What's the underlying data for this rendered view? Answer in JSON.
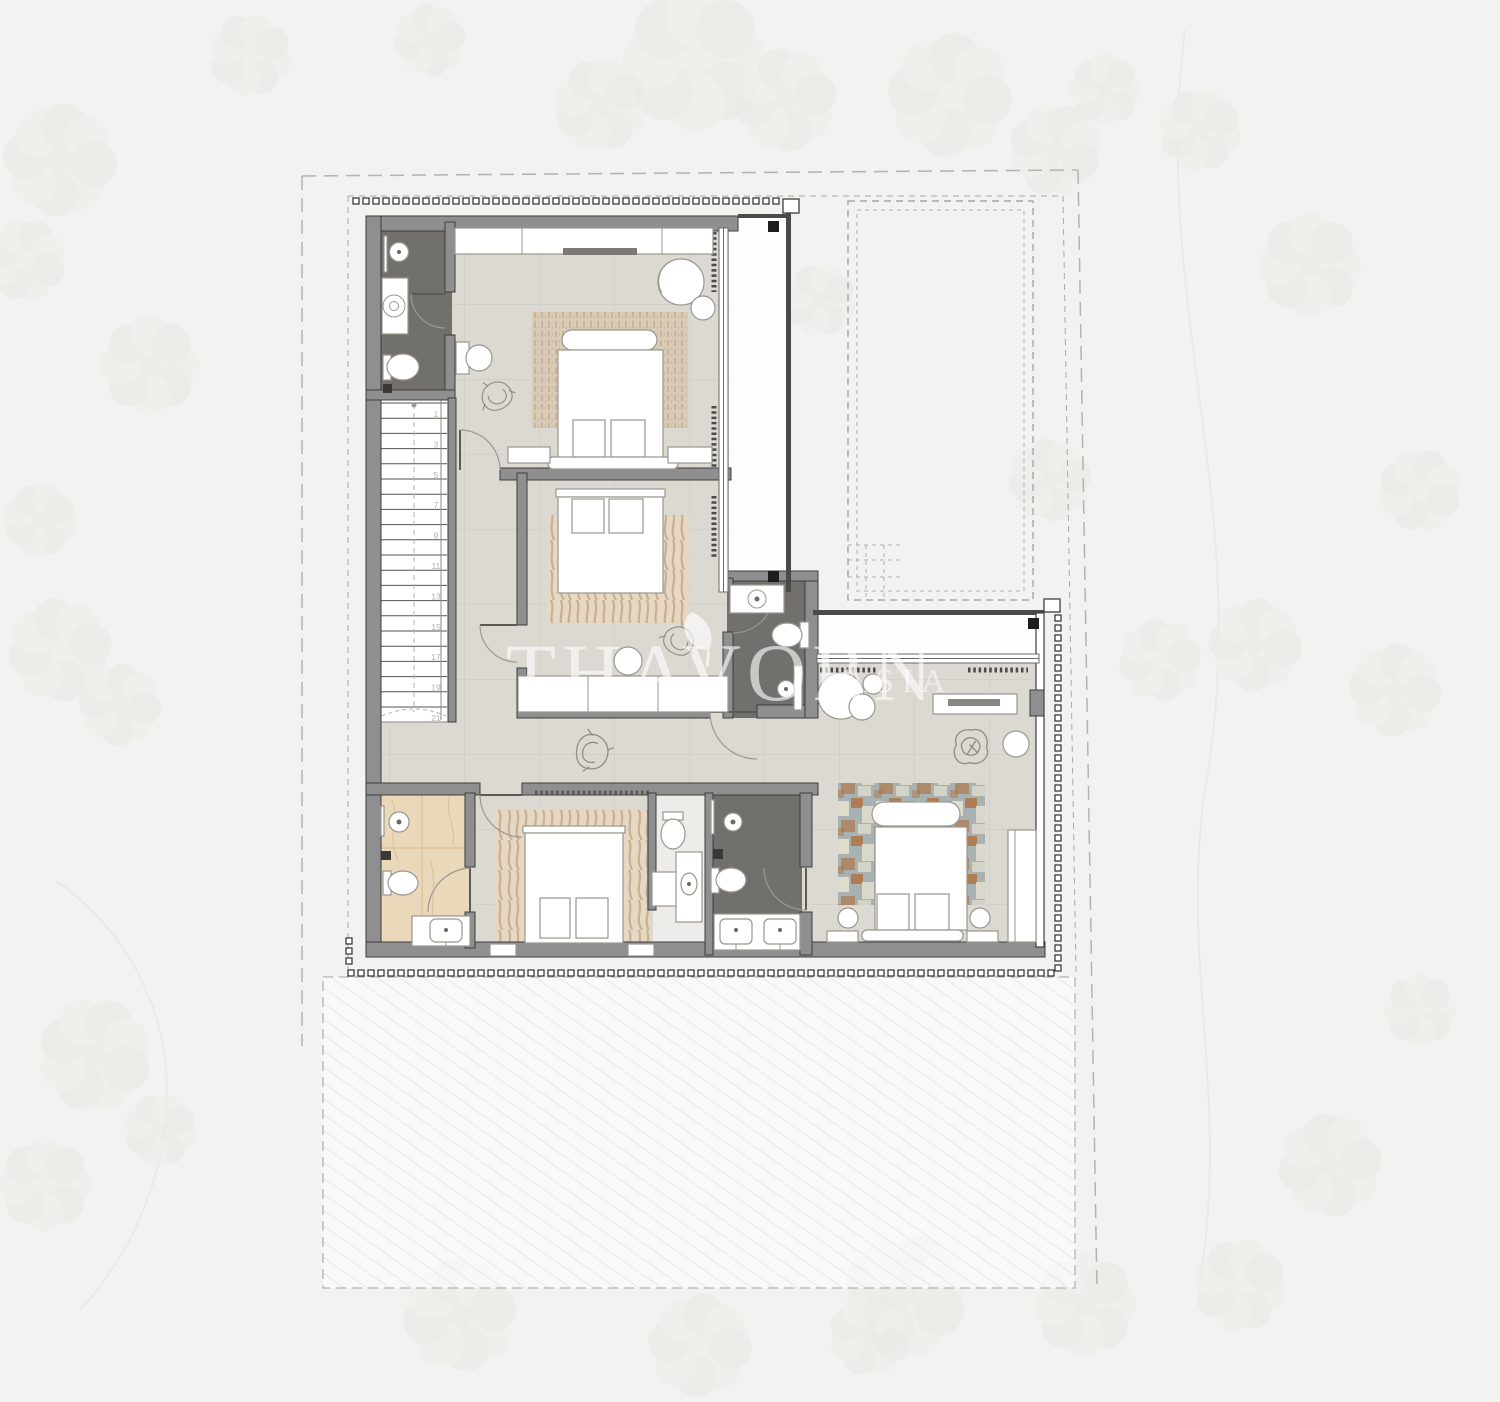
{
  "watermark": {
    "brand": "THAVORN",
    "region": "ASIA"
  },
  "stairs": {
    "labels": [
      "1",
      "3",
      "5",
      "7",
      "9",
      "11",
      "13",
      "15",
      "17",
      "19",
      "21"
    ]
  },
  "palette": {
    "bg": "#f2f2f0",
    "foliage": "#e9ebe6",
    "foliage2": "#eef0eb",
    "hatch": "#e3e3e1",
    "dash": "#b3b3b1",
    "setback": "#a8a8a6",
    "wall_fill": "#8f8f8f",
    "wall_edge": "#3d3d3d",
    "wall_dark": "#4a4a4a",
    "floor": "#dcd9d3",
    "floor_line": "#c9c6c0",
    "dark_bath": "#72706c",
    "beige_bath": "#e9d8ba",
    "beige_vein": "#d9ba8c",
    "rug_beige": "#d9cbb5",
    "rug_stripe": "#c0ab8f",
    "zebra_base": "#e7d8c4",
    "zebra_stripe": "#c3aa8a",
    "rug_master_a": "#a9b2b2",
    "rug_master_b": "#b06a33",
    "rug_master_c": "#e6e1d0",
    "furniture": "#ffffff",
    "furniture_line": "#9a978f",
    "sketch": "#8e8c86",
    "watermark": "#ffffff",
    "column": "#1d1d1b",
    "glass": "#6a6a68",
    "stair_num": "#b5b1a9"
  }
}
